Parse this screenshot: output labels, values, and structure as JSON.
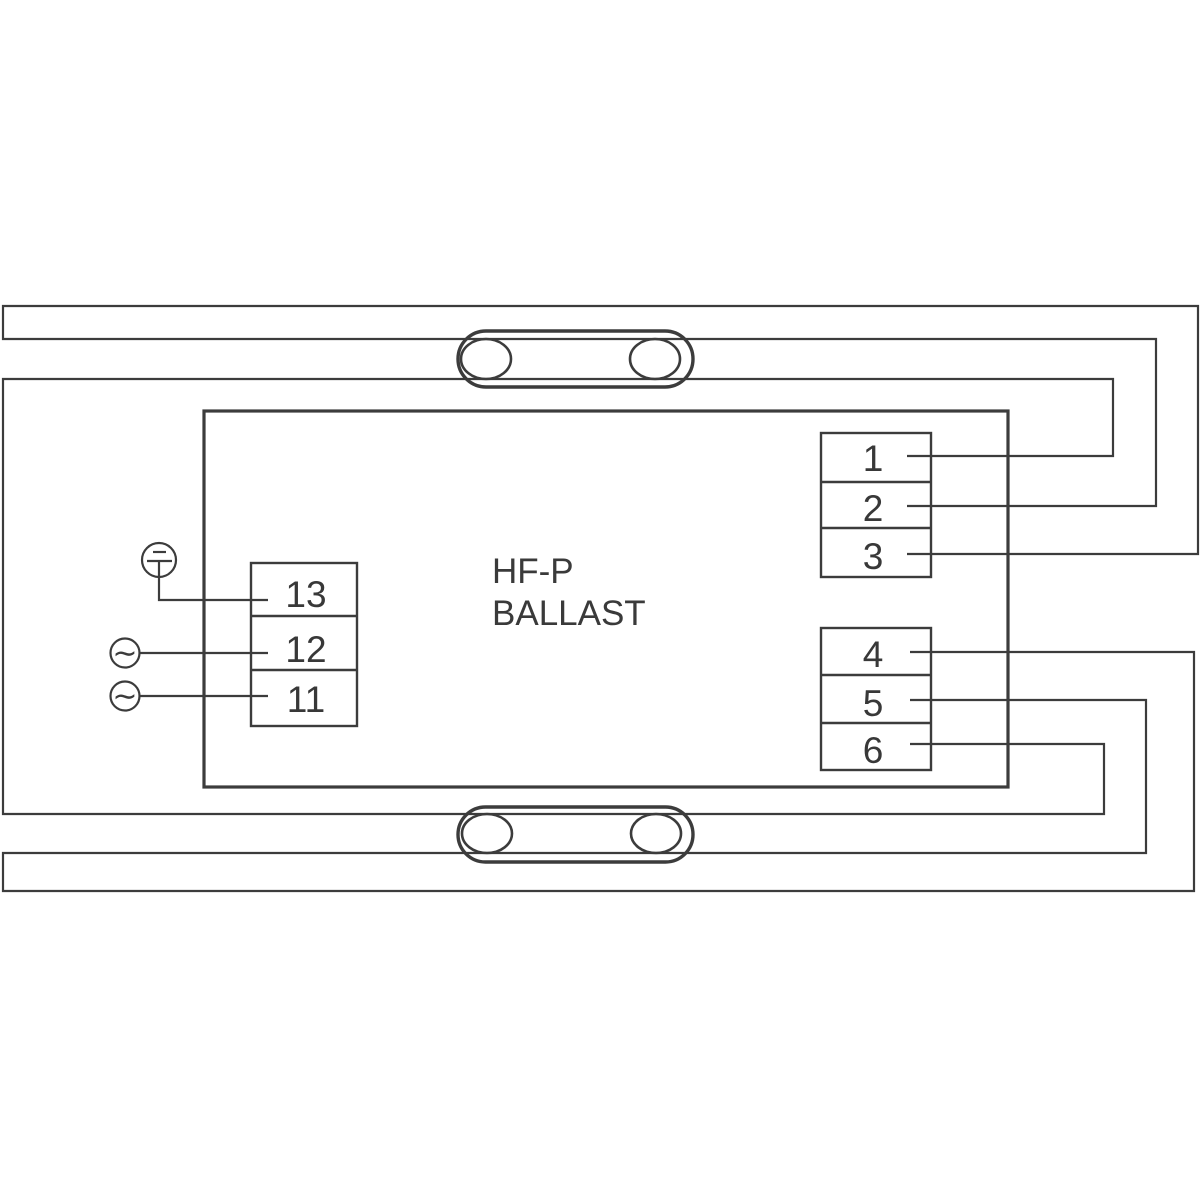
{
  "diagram": {
    "ballast": {
      "label_line1": "HF-P",
      "label_line2": "BALLAST"
    },
    "terminals": {
      "left": [
        "13",
        "12",
        "11"
      ],
      "top_right": [
        "1",
        "2",
        "3"
      ],
      "bottom_right": [
        "4",
        "5",
        "6"
      ]
    },
    "symbols": {
      "ac": "∼",
      "ground": "earth-ground"
    },
    "lamps": {
      "count": 2,
      "type": "fluorescent-tube"
    },
    "colors": {
      "line": "#3c3c3c",
      "text": "#383838",
      "background": "#ffffff"
    }
  }
}
